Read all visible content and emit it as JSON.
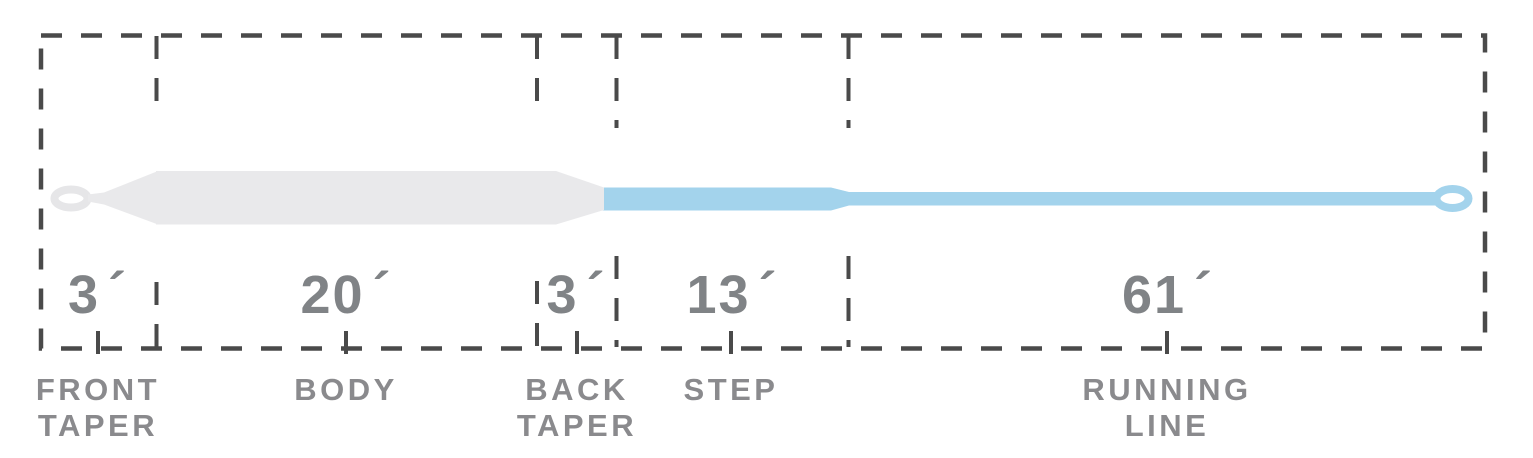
{
  "diagram": {
    "name": "fly-line-taper-diagram",
    "units": "feet",
    "colors": {
      "outline_dash": "#4a4a4a",
      "head_fill": "#e9e9eb",
      "running_line_fill": "#a3d3ec",
      "number_text": "#808386",
      "label_text": "#8a8a8d"
    },
    "segments": [
      {
        "id": "front-taper",
        "length": "3",
        "prime": "´",
        "label_line1": "FRONT",
        "label_line2": "TAPER"
      },
      {
        "id": "body",
        "length": "20",
        "prime": "´",
        "label_line1": "BODY",
        "label_line2": ""
      },
      {
        "id": "back-taper",
        "length": "3",
        "prime": "´",
        "label_line1": "BACK",
        "label_line2": "TAPER"
      },
      {
        "id": "step",
        "length": "13",
        "prime": "´",
        "label_line1": "STEP",
        "label_line2": ""
      },
      {
        "id": "running-line",
        "length": "61",
        "prime": "´",
        "label_line1": "RUNNING",
        "label_line2": "LINE"
      }
    ]
  }
}
